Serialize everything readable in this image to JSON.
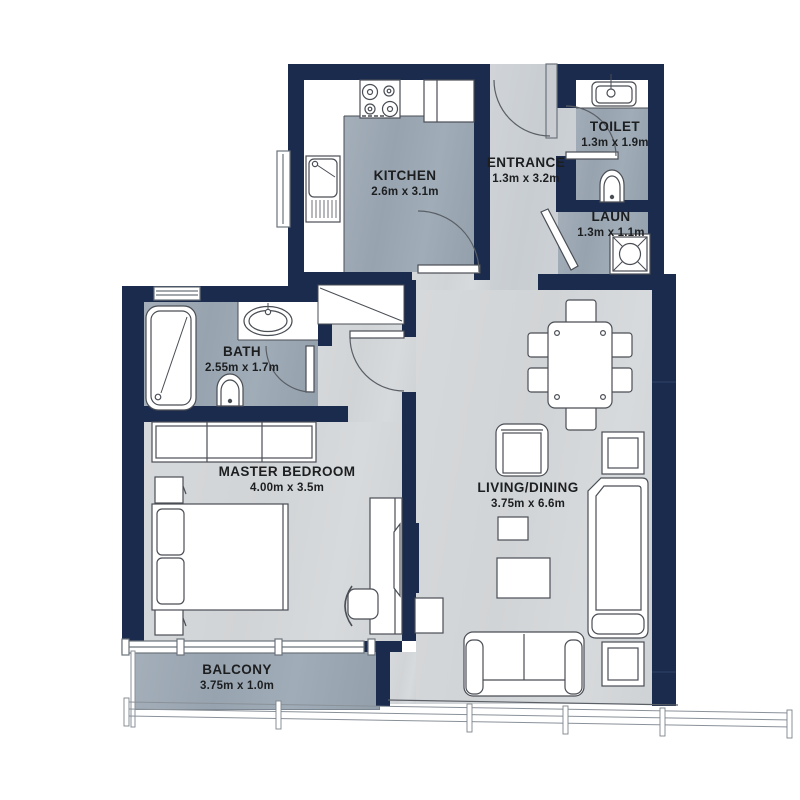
{
  "plan": {
    "type": "apartment-floor-plan",
    "colors": {
      "wall": "#1a2b4d",
      "floor_tile": "#9aa5b1",
      "floor_wood": "#d3d6d8",
      "floor_entrance": "#cbd0d4",
      "line": "#4a4e55"
    },
    "rooms": {
      "kitchen": {
        "name": "KITCHEN",
        "dims": "2.6m x 3.1m"
      },
      "entrance": {
        "name": "ENTRANCE",
        "dims": "1.3m x 3.2m"
      },
      "toilet": {
        "name": "TOILET",
        "dims": "1.3m x 1.9m"
      },
      "laundry": {
        "name": "LAUN",
        "dims": "1.3m x 1.1m"
      },
      "bath": {
        "name": "BATH",
        "dims": "2.55m x 1.7m"
      },
      "master_bedroom": {
        "name": "MASTER BEDROOM",
        "dims": "4.00m x 3.5m"
      },
      "living_dining": {
        "name": "LIVING/DINING",
        "dims": "3.75m x 6.6m"
      },
      "balcony": {
        "name": "BALCONY",
        "dims": "3.75m x 1.0m"
      }
    }
  }
}
